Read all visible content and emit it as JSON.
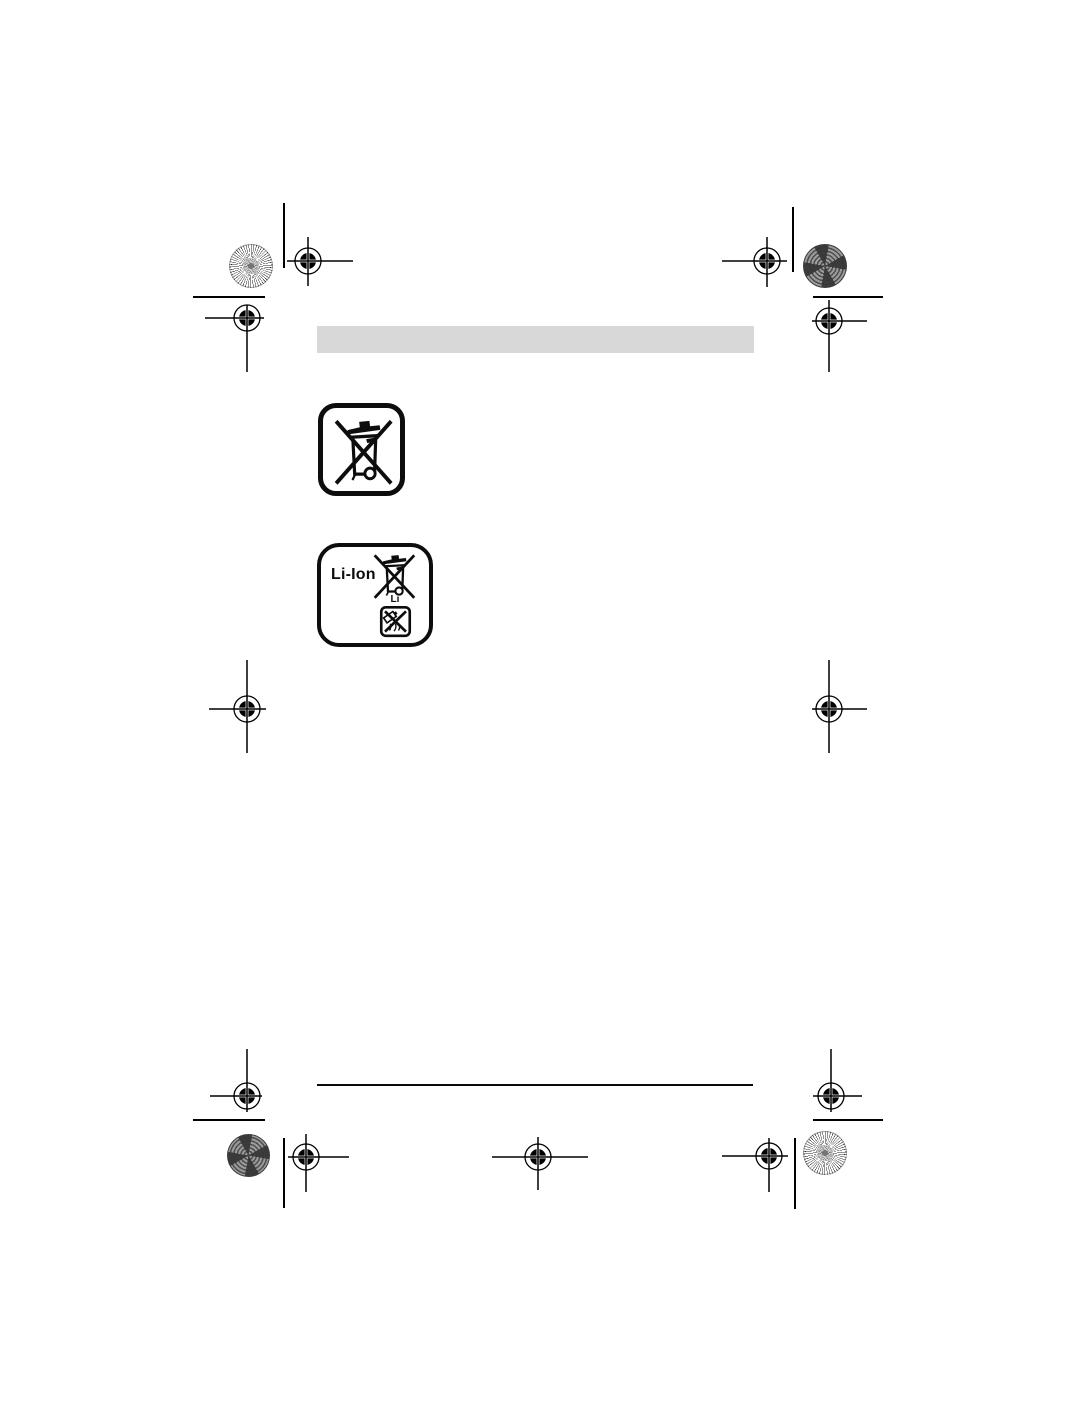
{
  "page": {
    "background_color": "#ffffff",
    "kind": "manual-page-proof"
  },
  "header_bar": {
    "color": "#d8d8d8"
  },
  "symbols": {
    "weee": {
      "icon": "crossed-out-wheeled-bin-icon"
    },
    "battery": {
      "label": "Li-Ion",
      "bin_caption": "Li",
      "bin_icon": "crossed-out-wheeled-bin-icon",
      "fire_icon": "crossed-out-battery-fire-icon"
    }
  },
  "footer": {
    "divider_color": "#0a0a0a"
  },
  "print_marks": {
    "registration_icon": "registration-crosshair-icon",
    "light_patch_icon": "starburst-color-patch-icon",
    "dark_patch_icon": "moire-color-patch-icon",
    "mark_color": "#000000"
  }
}
